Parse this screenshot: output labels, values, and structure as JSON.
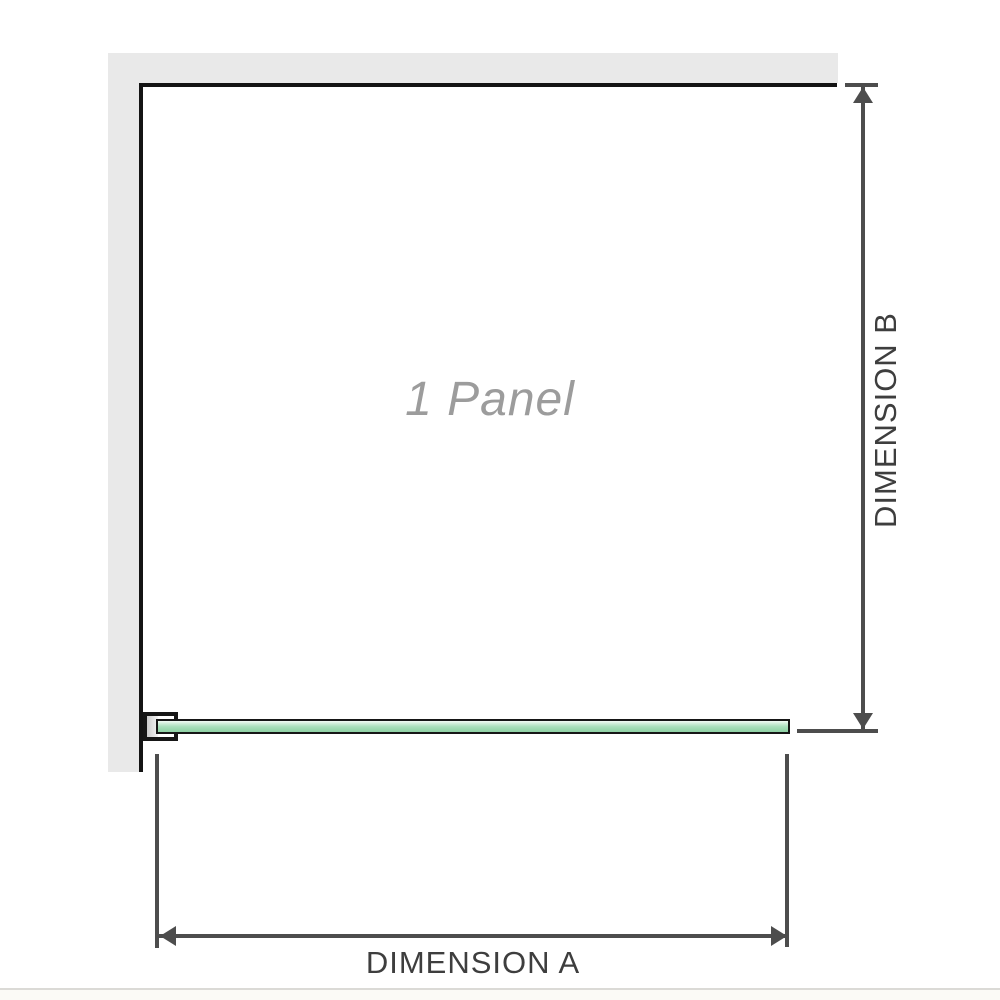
{
  "diagram": {
    "panel_label": "1 Panel",
    "dimension_a_label": "DIMENSION A",
    "dimension_b_label": "DIMENSION B"
  },
  "icons": {
    "dimension_b": [
      "arrow-up-icon",
      "arrow-down-icon"
    ],
    "dimension_a": [
      "arrow-left-icon",
      "arrow-right-icon"
    ]
  },
  "colors": {
    "background": "#ffffff",
    "wall_fill": "#e9e9e9",
    "wall_inner_edge": "#141414",
    "glass_outline": "#161616",
    "glass_gradient_top": "#f4fbf6",
    "glass_gradient_mid": "#abdfbd",
    "glass_gradient_bottom": "#8fd1a5",
    "bracket_fill": "#ffffff",
    "bracket_pad": "#cccccc",
    "dimension_line": "#4d4d4d",
    "dimension_text": "#3e3e3e",
    "panel_label_text": "#9c9c9c",
    "footer_line": "#dbdad6"
  }
}
